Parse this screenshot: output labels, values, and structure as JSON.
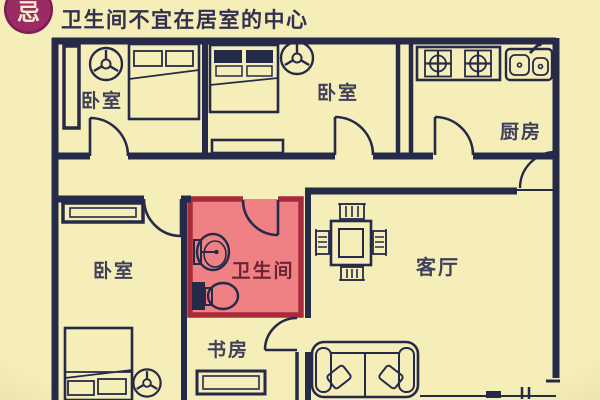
{
  "badge": {
    "label": "忌"
  },
  "title": "卫生间不宜在居室的中心",
  "rooms": {
    "bedroom_top_left": {
      "label": "卧室"
    },
    "bedroom_top_mid": {
      "label": "卧室"
    },
    "kitchen": {
      "label": "厨房"
    },
    "bedroom_left": {
      "label": "卧室"
    },
    "bathroom": {
      "label": "卫生间"
    },
    "living_room": {
      "label": "客厅"
    },
    "study": {
      "label": "书房"
    }
  },
  "colors": {
    "background": "#f5eeb8",
    "wall": "#262a49",
    "bathroom_fill": "#ef8185",
    "bathroom_border": "#a82a3c",
    "bathroom_label": "#6b2433",
    "badge_bg": "#9c2a64",
    "badge_text": "#f5ecc8",
    "title_color": "#32304e",
    "label_color": "#40405a"
  }
}
